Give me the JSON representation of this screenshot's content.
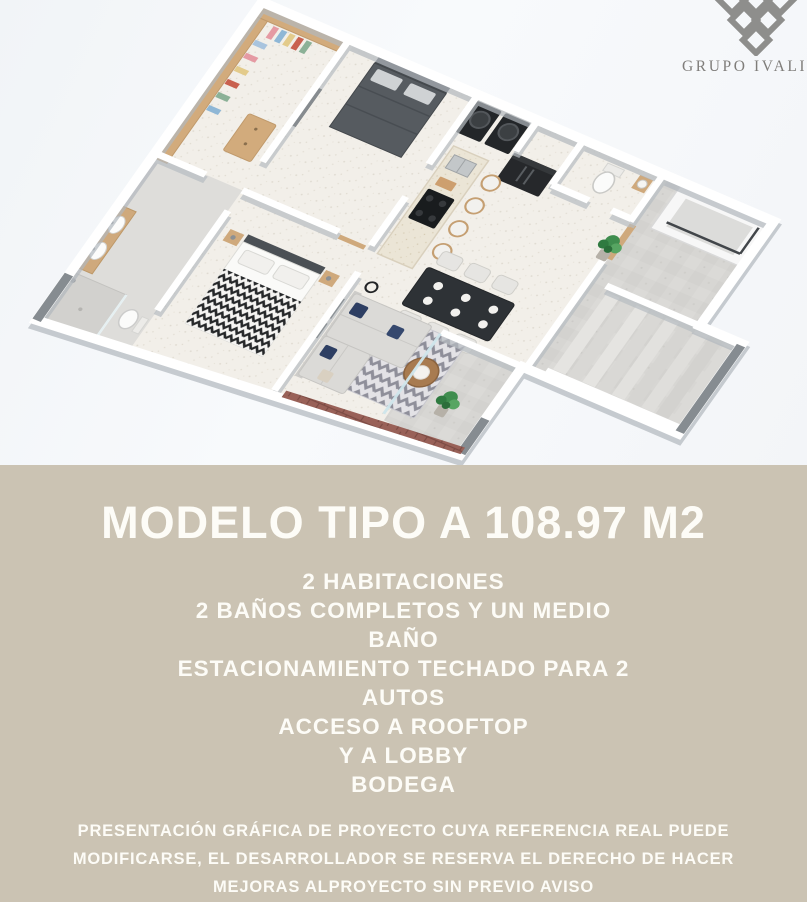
{
  "colors": {
    "hero_bg": "#f8fafc",
    "panel_bg": "#cbc3b3",
    "panel_text": "#fdfcf7",
    "logo_gray": "#8e8e8c",
    "brick_accent": "#996158",
    "navy_pillow": "#2e3f63",
    "wood": "#cfa97c"
  },
  "logo": {
    "text": "GRUPO IVALIVA",
    "icon": "diamond-lattice-icon"
  },
  "hero": {
    "description": "3D isometric render of apartment floor plan: two bedrooms, bathrooms, walk-in closet, kitchen island with stools, dining table, living room with chevron rug and brick accent wall, laundry, concrete patio with staircase and lobby access"
  },
  "panel": {
    "title": "MODELO TIPO A 108.97 M2",
    "features": [
      "2 HABITACIONES",
      "2 BAÑOS COMPLETOS Y UN MEDIO",
      "BAÑO",
      "ESTACIONAMIENTO TECHADO PARA 2",
      "AUTOS",
      "ACCESO A ROOFTOP",
      "Y A LOBBY",
      "BODEGA"
    ],
    "disclaimer": [
      "PRESENTACIÓN GRÁFICA DE PROYECTO CUYA REFERENCIA REAL PUEDE",
      "MODIFICARSE, EL DESARROLLADOR SE RESERVA EL DERECHO DE HACER",
      "MEJORAS ALPROYECTO SIN PREVIO AVISO"
    ]
  }
}
